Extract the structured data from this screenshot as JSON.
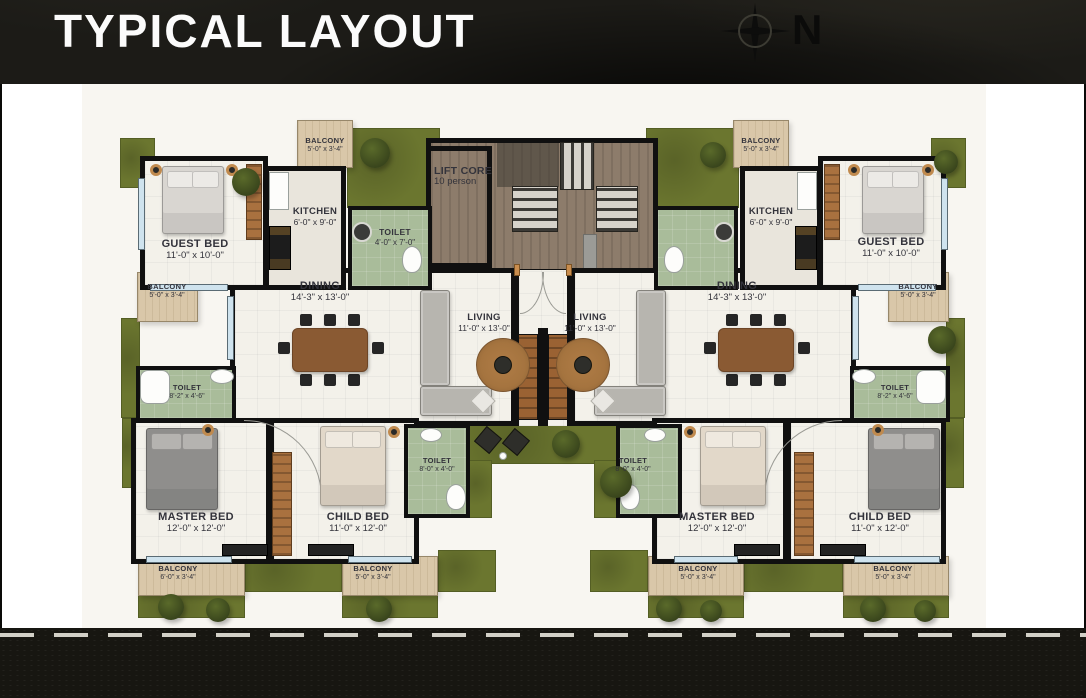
{
  "header": {
    "title": "TYPICAL LAYOUT",
    "compass_north": "N"
  },
  "palette": {
    "grass": "#6B762F",
    "balcony_floor": "#D9C7A9",
    "toilet_floor": "#A9BC9A",
    "room_floor": "#F3F1EA",
    "wood_floor": "#8D7C6B",
    "wall": "#101010",
    "window": "#CFE3EE",
    "paper": "#F8F6F1",
    "road": "#171611",
    "road_line": "#E8E6DE"
  },
  "rooms": {
    "lift_core": {
      "name": "LIFT CORE",
      "dims": "10 person"
    },
    "guest_bed_left": {
      "name": "GUEST BED",
      "dims": "11'-0\" x 10'-0\""
    },
    "kitchen_left": {
      "name": "KITCHEN",
      "dims": "6'-0\" x 9'-0\""
    },
    "toilet_common_left": {
      "name": "TOILET",
      "dims": "4'-0\" x 7'-0\""
    },
    "dining_left": {
      "name": "DINING",
      "dims": "14'-3\" x 13'-0\""
    },
    "living_left": {
      "name": "LIVING",
      "dims": "11'-0\" x 13'-0\""
    },
    "toilet_master_left": {
      "name": "TOILET",
      "dims": "8'-2\" x 4'-6\""
    },
    "master_bed_left": {
      "name": "MASTER BED",
      "dims": "12'-0\" x 12'-0\""
    },
    "child_bed_left": {
      "name": "CHILD BED",
      "dims": "11'-0\" x 12'-0\""
    },
    "toilet_child_left": {
      "name": "TOILET",
      "dims": "8'-0\" x 4'-0\""
    },
    "balcony_top_left": {
      "name": "BALCONY",
      "dims": "5'-0\" x 3'-4\""
    },
    "balcony_side_left": {
      "name": "BALCONY",
      "dims": "5'-0\" x 3'-4\""
    },
    "balcony_bottom_left_a": {
      "name": "BALCONY",
      "dims": "6'-0\" x 3'-4\""
    },
    "balcony_bottom_left_b": {
      "name": "BALCONY",
      "dims": "5'-0\" x 3'-4\""
    },
    "guest_bed_right": {
      "name": "GUEST BED",
      "dims": "11'-0\" x 10'-0\""
    },
    "kitchen_right": {
      "name": "KITCHEN",
      "dims": "6'-0\" x 9'-0\""
    },
    "dining_right": {
      "name": "DINING",
      "dims": "14'-3\" x 13'-0\""
    },
    "living_right": {
      "name": "LIVING",
      "dims": "11'-0\" x 13'-0\""
    },
    "toilet_master_right": {
      "name": "TOILET",
      "dims": "8'-2\" x 4'-6\""
    },
    "master_bed_right": {
      "name": "MASTER BED",
      "dims": "12'-0\" x 12'-0\""
    },
    "child_bed_right": {
      "name": "CHILD BED",
      "dims": "11'-0\" x 12'-0\""
    },
    "toilet_child_right": {
      "name": "TOILET",
      "dims": "8'-0\" x 4'-0\""
    },
    "balcony_top_right": {
      "name": "BALCONY",
      "dims": "5'-0\" x 3'-4\""
    },
    "balcony_side_right": {
      "name": "BALCONY",
      "dims": "5'-0\" x 3'-4\""
    },
    "balcony_bottom_right_a": {
      "name": "BALCONY",
      "dims": "5'-0\" x 3'-4\""
    },
    "balcony_bottom_right_b": {
      "name": "BALCONY",
      "dims": "5'-0\" x 3'-4\""
    }
  }
}
